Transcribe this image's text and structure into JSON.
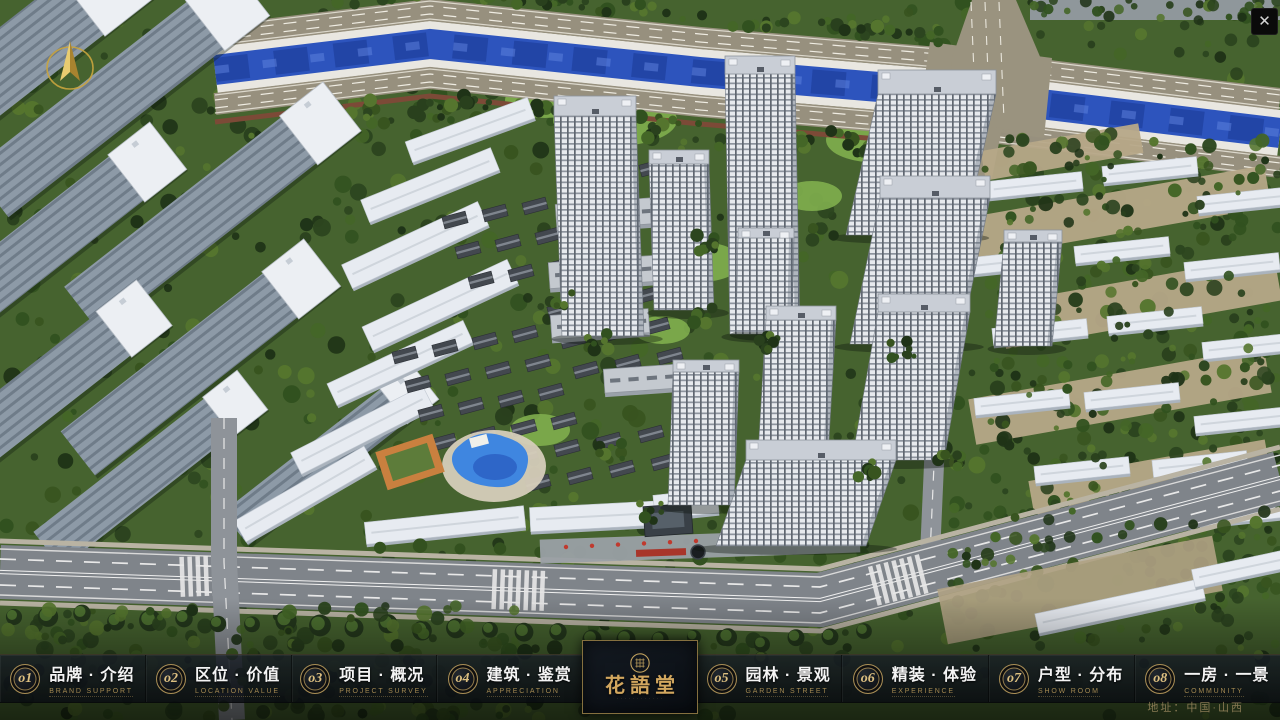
{
  "window": {
    "close_glyph": "✕"
  },
  "nav": {
    "items": [
      {
        "num": "o1",
        "zh": "品牌 · 介绍",
        "en": "BRAND SUPPORT"
      },
      {
        "num": "o2",
        "zh": "区位 · 价值",
        "en": "LOCATION VALUE"
      },
      {
        "num": "o3",
        "zh": "项目 · 概况",
        "en": "PROJECT SURVEY"
      },
      {
        "num": "o4",
        "zh": "建筑 · 鉴赏",
        "en": "APPRECIATION"
      },
      {
        "num": "o5",
        "zh": "园林 · 景观",
        "en": "GARDEN STREET"
      },
      {
        "num": "o6",
        "zh": "精装 · 体验",
        "en": "EXPERIENCE"
      },
      {
        "num": "o7",
        "zh": "户型 · 分布",
        "en": "SHOW ROOM"
      },
      {
        "num": "o8",
        "zh": "一房 · 一景",
        "en": "COMMUNITY"
      }
    ]
  },
  "logo": {
    "title": "花語堂",
    "subtext": "· · · · · · · · · · · ·"
  },
  "footer": {
    "address": "地址：中国·山西"
  },
  "colors": {
    "accent_gold": "#c9a96a",
    "nav_english_gold": "#a28851",
    "nav_text_white": "#f4f4f4",
    "bar_background": "rgba(13,18,24,0.80)",
    "river_blue": "#2d54bd",
    "foliage_green": "#2c4520"
  }
}
